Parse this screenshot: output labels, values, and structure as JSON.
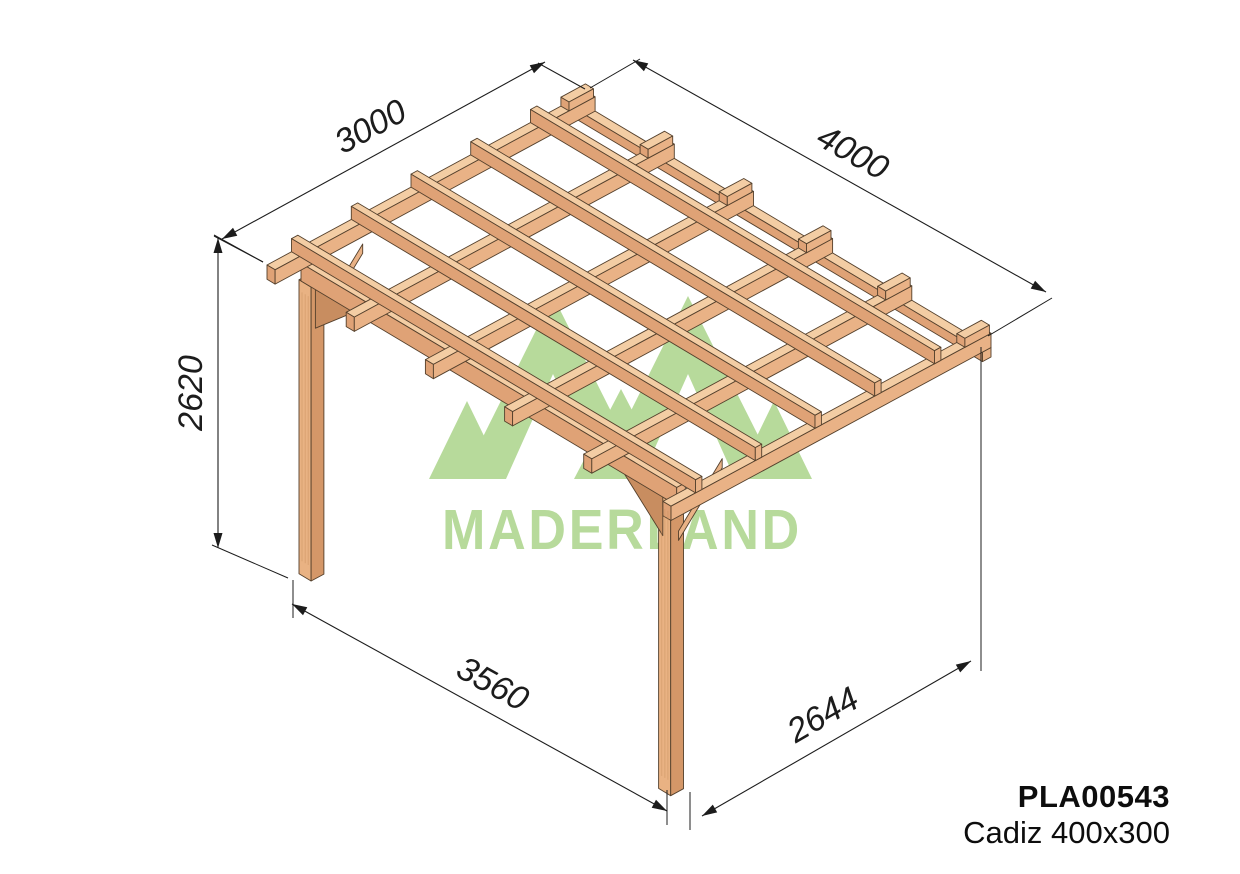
{
  "product": {
    "code": "PLA00543",
    "name": "Cadiz 400x300"
  },
  "watermark": {
    "brand": "MADERLAND",
    "color": "#b7da9b"
  },
  "dimensions": {
    "depth_top": {
      "label": "3000"
    },
    "width_top": {
      "label": "4000"
    },
    "height_left": {
      "label": "2620"
    },
    "width_bottom": {
      "label": "3560"
    },
    "depth_bottom": {
      "label": "2644"
    }
  },
  "colors": {
    "background": "#ffffff",
    "wood_top": "#f3cda4",
    "wood_front": "#dfa276",
    "wood_side": "#e9b286",
    "wood_post": "#e9b283",
    "wood_post_side": "#d49768",
    "wood_dark": "#c88d60",
    "outline": "#54402c",
    "dim_line": "#1c1c1c",
    "text": "#0d0d0d"
  }
}
